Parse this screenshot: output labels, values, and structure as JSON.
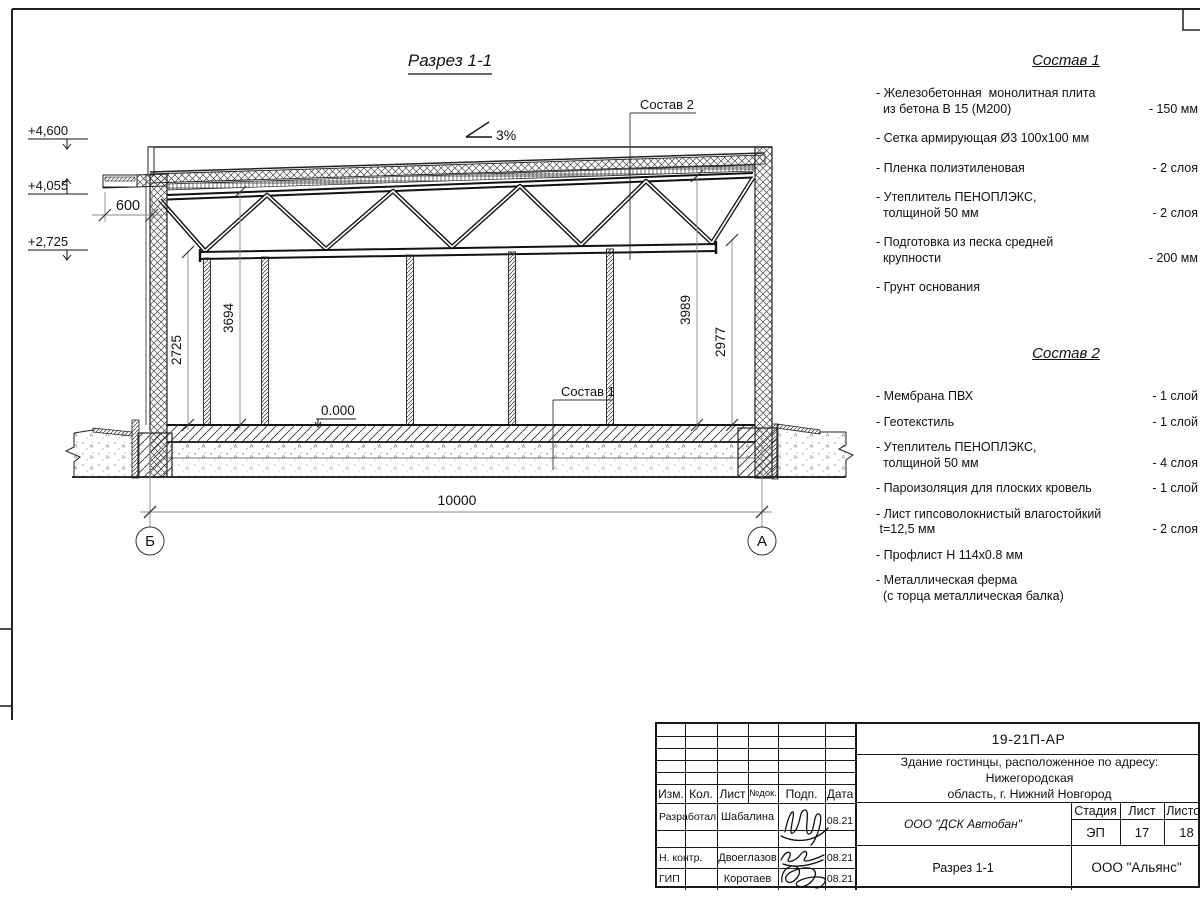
{
  "sheet": {
    "section_title": "Разрез 1-1",
    "slope_label": "3%",
    "elevations": {
      "parapet": "+4,600",
      "canopy": "+4,055",
      "truss": "+2,725"
    },
    "dims": {
      "overhang": "600",
      "h_left": "2725",
      "h_mid": "3694",
      "h_right": "3989",
      "h_beam": "2977",
      "span": "10000",
      "level_zero": "0.000"
    },
    "axes": {
      "left": "Б",
      "right": "А"
    },
    "callouts": {
      "c1": "Состав 1",
      "c2": "Состав 2"
    }
  },
  "sostav1": {
    "title": "Состав 1",
    "items": [
      {
        "name": "- Железобетонная  монолитная плита\n  из бетона В 15 (М200)",
        "qty": "- 150 мм"
      },
      {
        "name": "- Сетка армирующая Ø3 100х100 мм",
        "qty": ""
      },
      {
        "name": "- Пленка полиэтиленовая",
        "qty": "-  2 слоя"
      },
      {
        "name": "- Утеплитель ПЕНОПЛЭКС,\n  толщиной 50 мм",
        "qty": "- 2 слоя"
      },
      {
        "name": "- Подготовка из песка средней\n  крупности",
        "qty": "- 200 мм"
      },
      {
        "name": "- Грунт основания",
        "qty": ""
      }
    ]
  },
  "sostav2": {
    "title": "Состав 2",
    "items": [
      {
        "name": "- Мембрана ПВХ",
        "qty": "- 1 слой"
      },
      {
        "name": "- Геотекстиль",
        "qty": "- 1 слой"
      },
      {
        "name": "- Утеплитель ПЕНОПЛЭКС,\n  толщиной 50 мм",
        "qty": "- 4 слоя"
      },
      {
        "name": "- Пароизоляция для плоских кровель",
        "qty": "- 1 слой"
      },
      {
        "name": "- Лист гипсоволокнистый влагостойкий\n t=12,5 мм",
        "qty": "- 2 слоя"
      },
      {
        "name": "- Профлист Н 114х0.8 мм",
        "qty": ""
      },
      {
        "name": "- Металлическая ферма\n  (с торца металлическая балка)",
        "qty": ""
      }
    ]
  },
  "titleblock": {
    "doc_number": "19-21П-АР",
    "project_name": "Здание гостинцы, расположенное по адресу: Нижегородская\nобласть, г. Нижний Новгород",
    "company": "ООО \"ДСК Автобан\"",
    "drawing_title": "Разрез 1-1",
    "org": "ООО \"Альянс\"",
    "stage_label": "Стадия",
    "sheet_label": "Лист",
    "sheets_label": "Листов",
    "stage": "ЭП",
    "sheet_no": "17",
    "sheets_total": "18",
    "header": {
      "izm": "Изм.",
      "kol": "Кол.",
      "list": "Лист",
      "ndoc": "№док.",
      "podp": "Подп.",
      "data": "Дата"
    },
    "rows": [
      {
        "role": "Разработал",
        "name": "Шабалина",
        "date": "08.21"
      },
      {
        "role": "Н. контр.",
        "name": "Двоеглазов",
        "date": "08.21"
      },
      {
        "role": "ГИП",
        "name": "Коротаев",
        "date": "08.21"
      }
    ]
  }
}
